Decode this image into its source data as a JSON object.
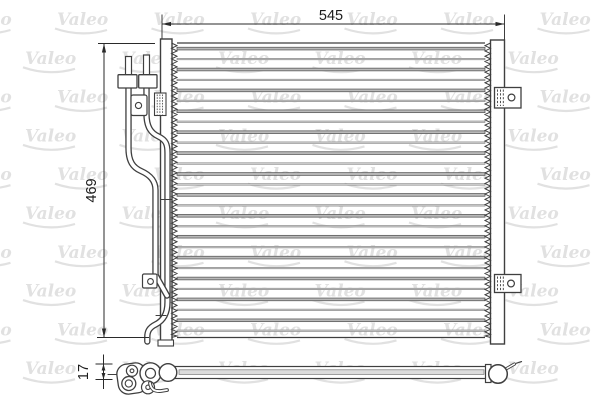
{
  "watermark": {
    "text": "Valeo",
    "color": "#e1e1e1"
  },
  "dimensions": {
    "width": "545",
    "height": "469",
    "depth": "17"
  },
  "drawing": {
    "line_color": "#3f3f3f",
    "dim_color": "#2a2a2a",
    "tube_fill_dark": "#b9b9b9",
    "tube_fill_light": "#d2d2d2",
    "tube_count": 28,
    "tube_step": 10.45,
    "fin_tooth_period": 5.3,
    "watermark_rows": 10,
    "watermark_cols": 7
  }
}
